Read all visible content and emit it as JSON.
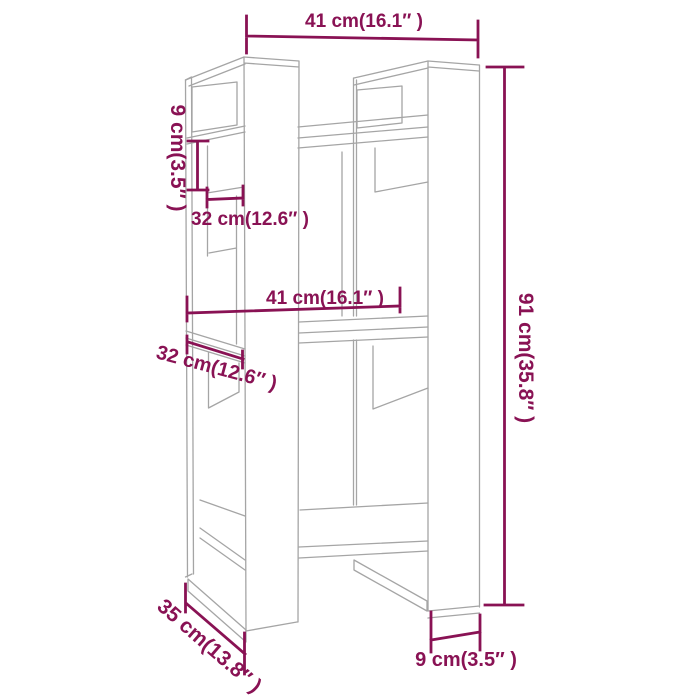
{
  "canvas": {
    "width": 700,
    "height": 700,
    "background": "#ffffff"
  },
  "diagram": {
    "type": "product-dimension-line-drawing",
    "subject": "book-cabinet-room-divider",
    "colors": {
      "dimension": "#891254",
      "outline": "#a5a5a5",
      "background": "#ffffff"
    },
    "labels": {
      "top_width": "41 cm(16.1″ )",
      "upper_left_shelf_gap": "9 cm(3.5″ )",
      "upper_left_depth": "32 cm(12.6″ )",
      "middle_width": "41 cm(16.1″ )",
      "middle_left_depth": "32 cm(12.6″ )",
      "overall_height": "91 cm(35.8″ )",
      "bottom_left_depth": "35 cm(13.8″ )",
      "bottom_right_width": "9 cm(3.5″ )"
    }
  }
}
